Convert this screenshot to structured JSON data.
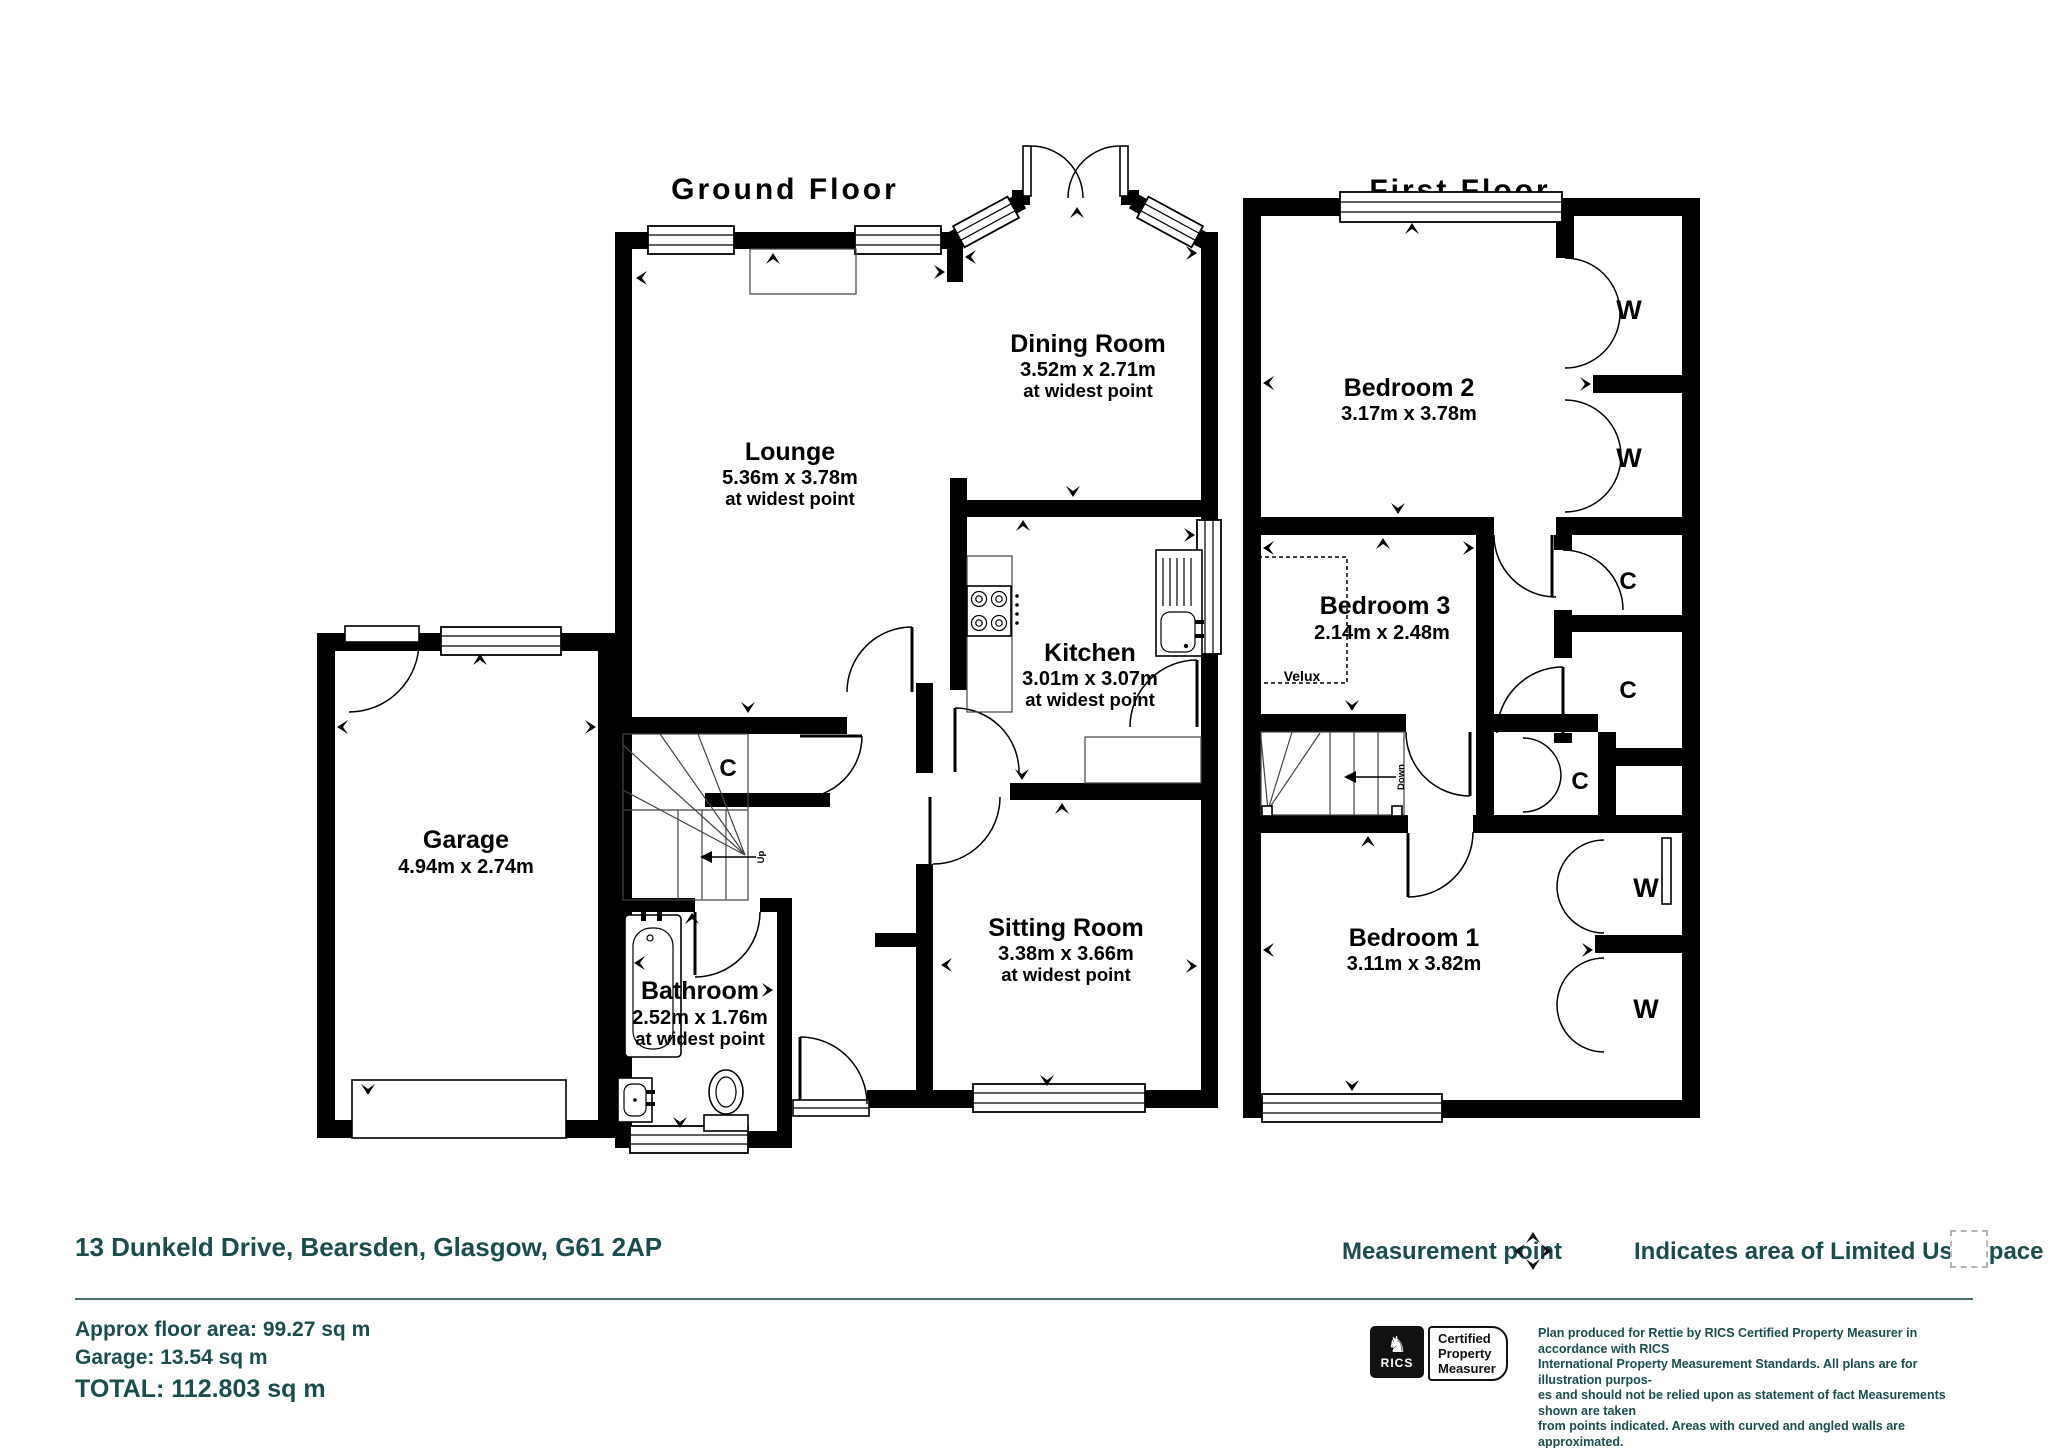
{
  "ground_floor": {
    "title": "Ground Floor",
    "lounge": {
      "name": "Lounge",
      "dims": "5.36m x 3.78m",
      "note": "at widest point"
    },
    "dining": {
      "name": "Dining Room",
      "dims": "3.52m x 2.71m",
      "note": "at widest point"
    },
    "kitchen": {
      "name": "Kitchen",
      "dims": "3.01m x 3.07m",
      "note": "at widest point"
    },
    "sitting": {
      "name": "Sitting Room",
      "dims": "3.38m x 3.66m",
      "note": "at widest point"
    },
    "bathroom": {
      "name": "Bathroom",
      "dims": "2.52m x 1.76m",
      "note": "at widest point"
    },
    "garage": {
      "name": "Garage",
      "dims": "4.94m x 2.74m"
    },
    "closet": "C",
    "up": "Up"
  },
  "first_floor": {
    "title": "First Floor",
    "bedroom1": {
      "name": "Bedroom 1",
      "dims": "3.11m x 3.82m"
    },
    "bedroom2": {
      "name": "Bedroom 2",
      "dims": "3.17m x 3.78m"
    },
    "bedroom3": {
      "name": "Bedroom 3",
      "dims": "2.14m x 2.48m"
    },
    "velux": "Velux",
    "wardrobe": "W",
    "closet": "C",
    "down": "Down"
  },
  "footer": {
    "address": "13 Dunkeld Drive, Bearsden, Glasgow, G61 2AP",
    "measurement_point": "Measurement point",
    "limited_use": "Indicates area of  Limited Use Space",
    "approx_area": "Approx floor area: 99.27 sq m",
    "garage_area": "Garage: 13.54 sq m",
    "total_area": "TOTAL: 112.803 sq m",
    "rics_brand": "RICS",
    "rics_cert_line1": "Certified",
    "rics_cert_line2": "Property",
    "rics_cert_line3": "Measurer",
    "disclaimer_line1": "Plan produced for Rettie by RICS Certified Property Measurer in accordance with RICS",
    "disclaimer_line2": "International Property  Measurement Standards.  All plans are for illustration purpos-",
    "disclaimer_line3": "es and should not be relied upon as statement of fact Measurements shown are taken",
    "disclaimer_line4": "from points indicated. Areas with curved and angled walls are approximated.",
    "accent_color": "#1b4d4d"
  }
}
